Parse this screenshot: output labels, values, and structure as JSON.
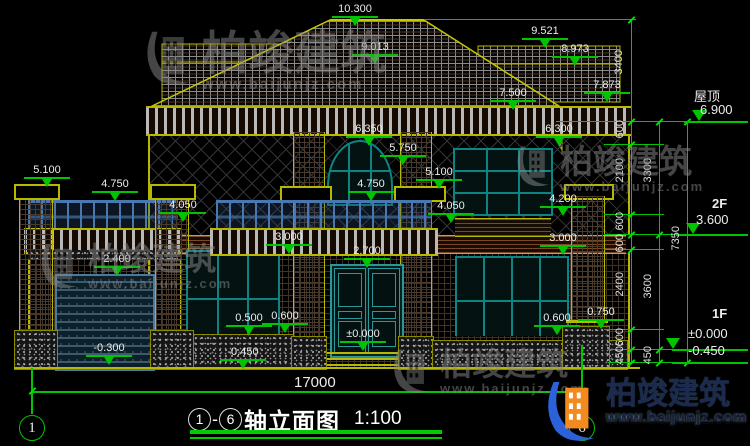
{
  "drawing_title": {
    "axis_from": "1",
    "axis_to": "6",
    "dash": "-",
    "name": "轴立面图",
    "scale": "1:100"
  },
  "brand": {
    "name": "柏竣建筑",
    "url": "www.baijunjz.com"
  },
  "watermark": {
    "name": "柏竣建筑",
    "url": "www.baijunjz.com"
  },
  "axes": {
    "left": "1",
    "right": "6"
  },
  "levels": {
    "roof_label": "屋顶",
    "roof_value": "6.900",
    "f2_label": "2F",
    "f2_value": "3.600",
    "f1_label": "1F",
    "f1_value": "±0.000",
    "f1_below": "-0.450"
  },
  "markers": [
    "10.300",
    "9.013",
    "9.521",
    "8.973",
    "7.873",
    "7.500",
    "6.350",
    "6.300",
    "5.750",
    "5.100",
    "4.750",
    "5.100",
    "4.750",
    "4.050",
    "4.050",
    "4.200",
    "3.000",
    "3.000",
    "2.700",
    "2.400",
    "0.500",
    "0.600",
    "0.600",
    "0.750",
    "±0.000",
    "-0.300",
    "-0.450"
  ],
  "dims": {
    "total_width": "17000",
    "roof_height": "3400",
    "inner": [
      "600",
      "2100",
      "600",
      "600",
      "2400",
      "600",
      "450"
    ],
    "mid": [
      "3300",
      "3600",
      "450"
    ],
    "total_height": "7350"
  },
  "colors": {
    "dimension_green": "#00c400",
    "cad_yellow": "#b8b800",
    "text_white": "#ececec",
    "window_teal": "#0d8484",
    "railing_blue": "#4878b0",
    "brand_orange": "#f28a1e",
    "brand_blue": "#2b62d9"
  }
}
